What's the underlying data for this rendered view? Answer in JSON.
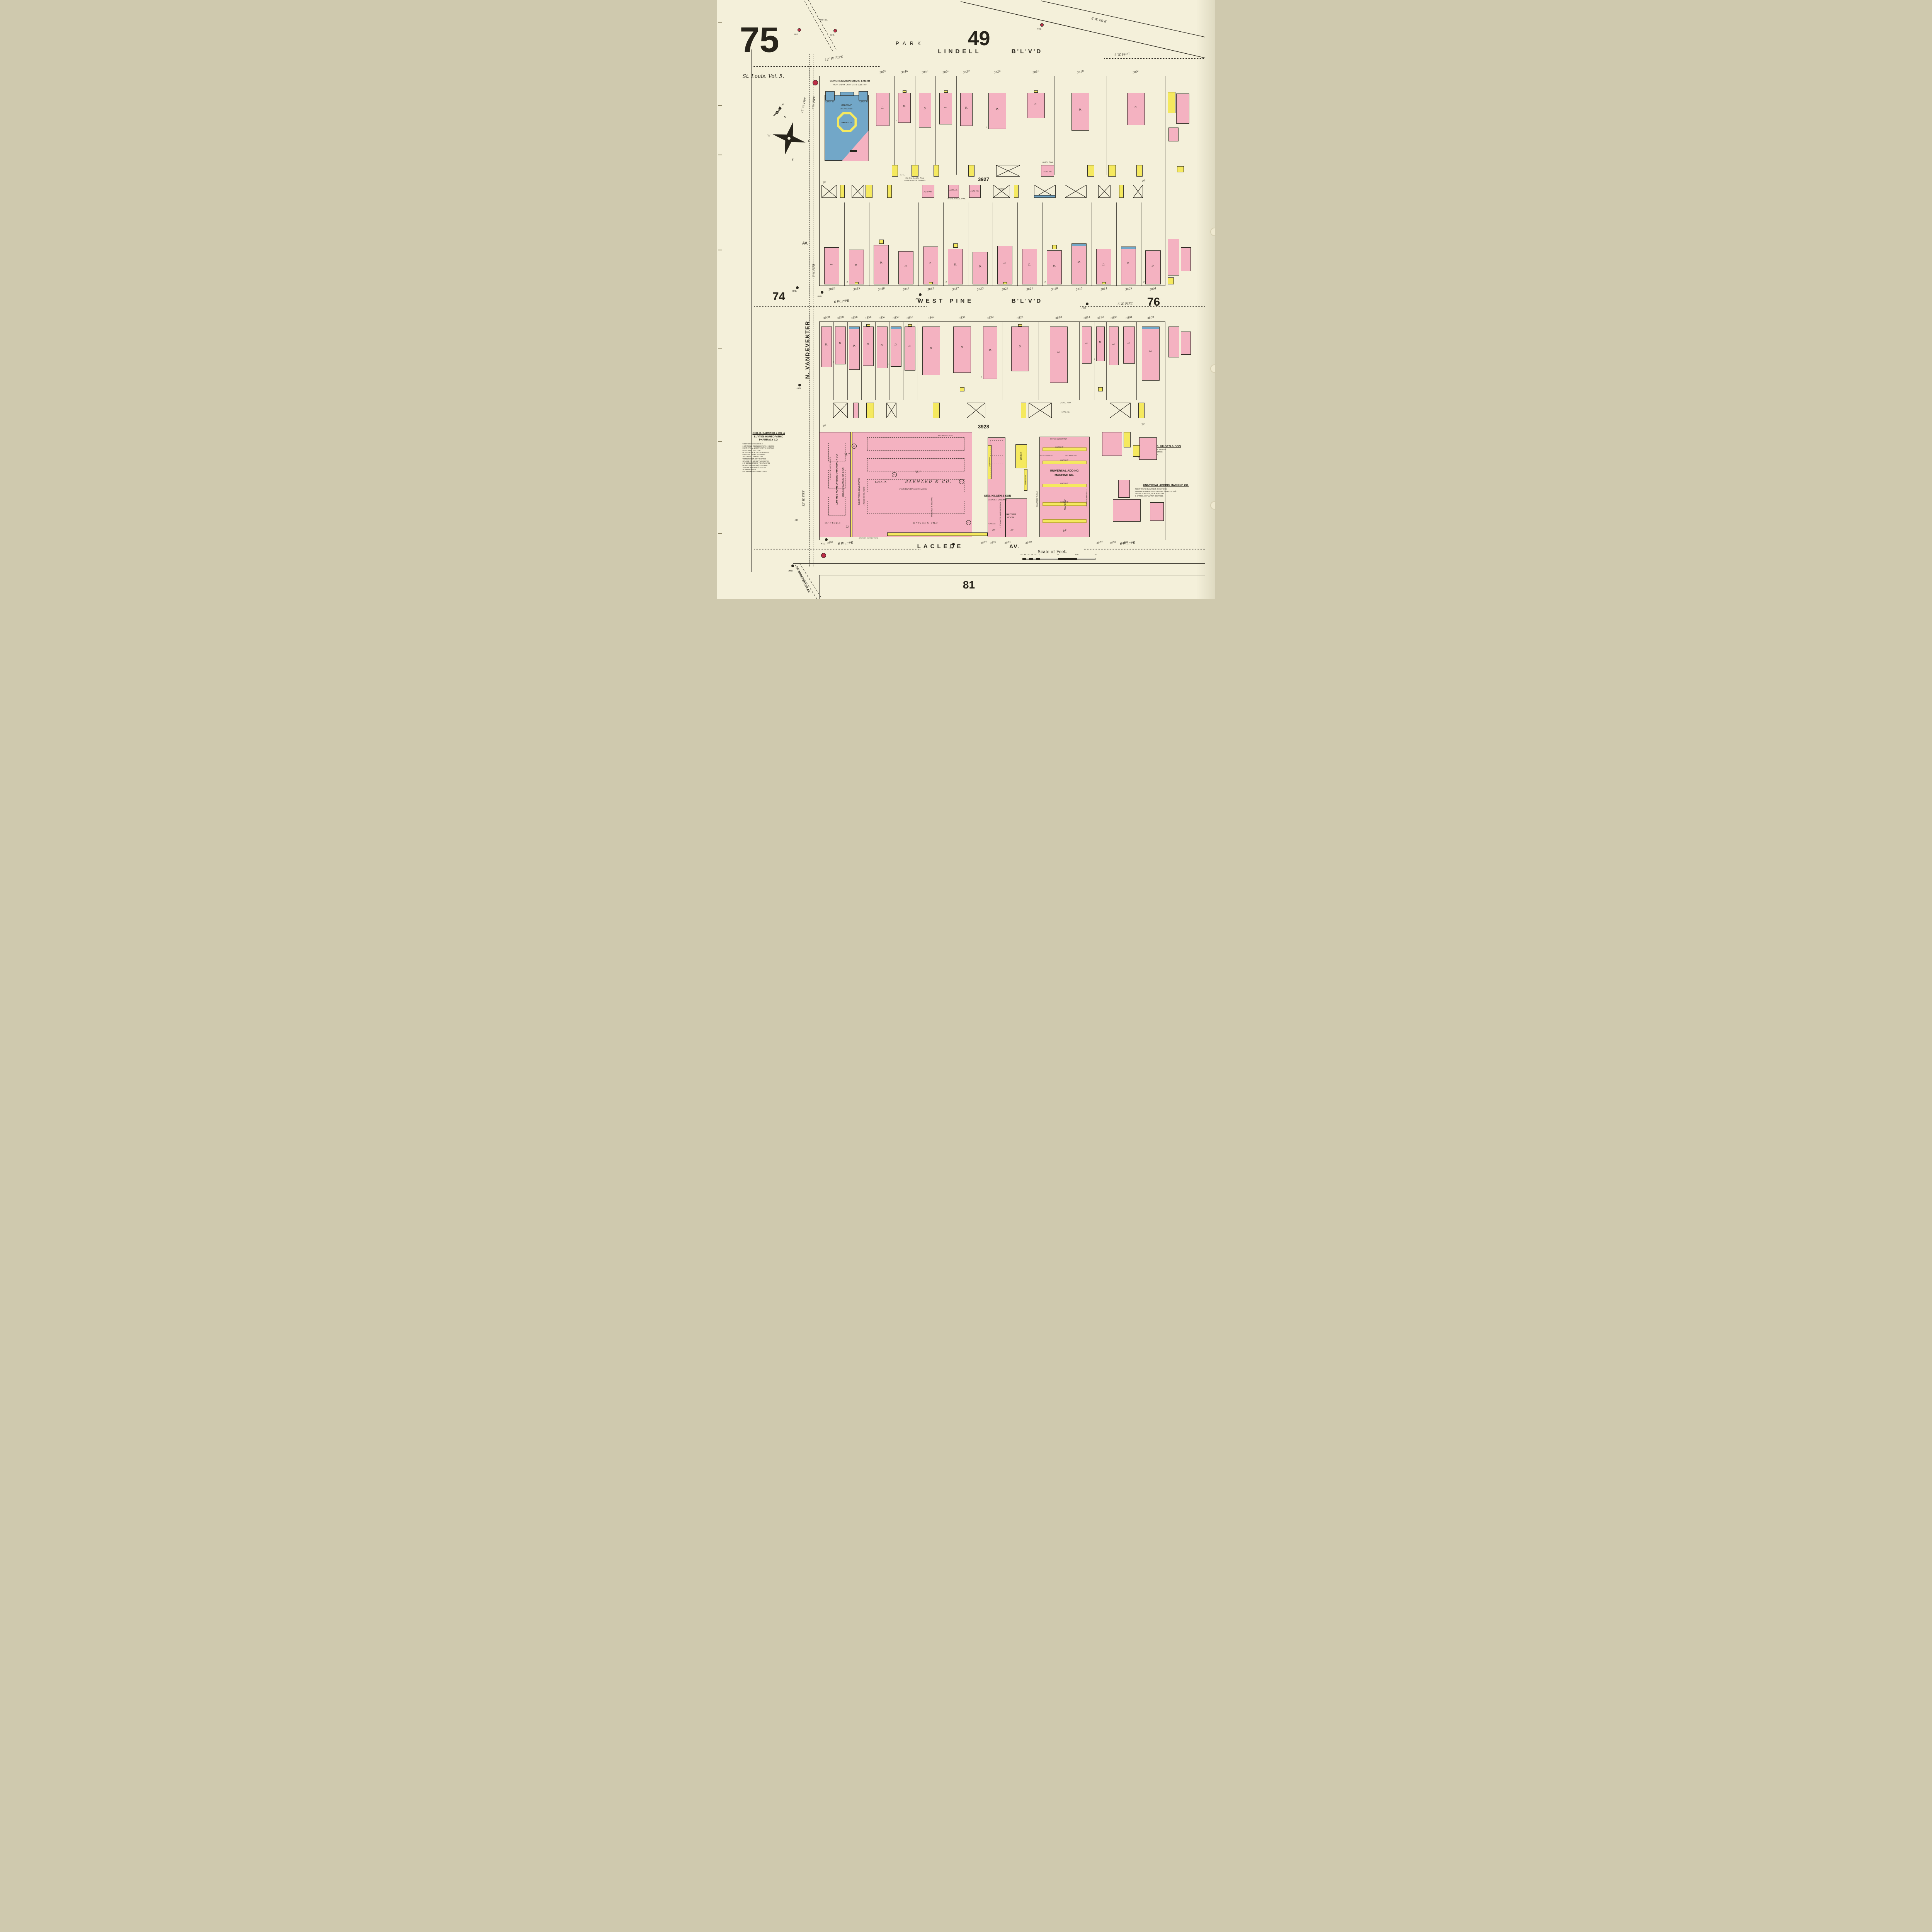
{
  "page": {
    "sheet_number": "75",
    "volume": "St. Louis. Vol. 5.",
    "adjacent_top": "49",
    "adjacent_left": "74",
    "adjacent_right": "76",
    "adjacent_bottom": "81"
  },
  "streets": {
    "park": "PARK",
    "lindell_1": "LINDELL",
    "lindell_2": "B'L'V'D",
    "west_pine_1": "WEST PINE",
    "west_pine_2": "B'L'V'D",
    "laclede_1": "LACLEDE",
    "laclede_2": "AV.",
    "vandeventer": "N. VANDEVENTER",
    "vandeventer_av": "AV.",
    "s_vandeventer": "S.VANDEVENTER AV."
  },
  "pipes": {
    "p12": "12″ W. PIPE",
    "p6": "6 W. PIPE"
  },
  "symbols": {
    "dwelling": "D.",
    "hydrant": "HYD.",
    "patrol": "PATROL",
    "auto_house": "AUTO HO.",
    "out_house": "OUT HO.",
    "sprinkler": "A.S",
    "sleeping_closet": "SL. CL.",
    "stories2": "2"
  },
  "blocks": {
    "b3927": {
      "number": "3927",
      "lindell_lots": [
        "3852",
        "3846",
        "3840",
        "3836",
        "3832",
        "3824",
        "3818",
        "3810",
        "3800"
      ],
      "west_pine_lots": [
        "3863",
        "3855",
        "3849",
        "3847",
        "3843",
        "3837",
        "3833",
        "3829",
        "3821",
        "3819",
        "3815",
        "3811",
        "3805",
        "3801"
      ],
      "synagogue": {
        "name": "CONGREGATION SHARE EMETH",
        "utilities": "HEAT: STEAM, LIGHT: GAS & ELECTRIC",
        "tower_left": "TOWER 80'",
        "tower_right": "TOWER 45'",
        "balcony": "BALCONY",
        "eaves": "30' TO EAVES",
        "raised": "RAISED 15'"
      },
      "tank_note_1a": "550 GAL. GASOL. TANK",
      "tank_note_1b": "BURIED UNDER GROUND",
      "tank_note_2": "60 GAL. GASOL. TANK",
      "tank_note_3": "GASOL. TANK",
      "alley_width": "20'"
    },
    "b3928": {
      "number": "3928",
      "west_pine_lots": [
        "3860",
        "3858",
        "3856",
        "3854",
        "3852",
        "3850",
        "3848",
        "3842",
        "3836",
        "3832",
        "3828",
        "3818",
        "3814",
        "3812",
        "3808",
        "3804",
        "3800"
      ],
      "laclede_lots": [
        "3863",
        "3827",
        "3825",
        "3821",
        "3819",
        "3807",
        "3803",
        "3801"
      ],
      "tank_note": "GASOL. TANK",
      "alley_width": "20'",
      "frontage_60": "60'"
    }
  },
  "factory": {
    "rows2": "2 ROWS OF WOOD POSTS",
    "luyties_vertical": "LUYTIES HOMEOPATHIC PHARMACY CO.",
    "medicine": "MEDICINE FACTORY 1ST & 2ND",
    "bldg_a": "\"A.\"",
    "bldg_b": "\"B.\"",
    "sales": "SALES ROOM & ENGRAVING",
    "rows4": "4 ROWS WOOD POSTS",
    "printing": "PRINTING & BINDING",
    "geo_d": "GEO. D.",
    "barnard": "BARNARD & CO.",
    "see_margin": "FOR REPORT SEE MARGIN",
    "wood_posts_1st": "WOOD POSTS 1ST",
    "offices": "OFFICES",
    "offices_2nd": "OFFICES 2ND",
    "kilgen": "GEO. KILGEN & SON",
    "organs": "CHURCH ORGANS",
    "bench": "1 ROW WOOD WORKING BENCH.",
    "office": "OFFICE",
    "erecting_1": "ERECTING",
    "erecting_2": "ROOM",
    "lumber": "LUMBER",
    "lumber_shed": "LUMBER SHED",
    "concrete": "CONCRETE FLOOR",
    "universal_1": "UNIVERSAL ADDING",
    "universal_2": "MACHINE CO.",
    "machine_vert": "MACHINE",
    "raised5": "RAISED 5'",
    "generator": "400 AMP. GENERATOR",
    "tile_wall": "TILE WALL 2ND",
    "rows7": "7 ROWS WOOD POSTS",
    "steamer": "STEAMER CONNECTIONS",
    "d16": "16'",
    "d22": "22'",
    "d26": "26'"
  },
  "reports": {
    "barnard": {
      "title": [
        "GEO. D. BARNARD & CO. &",
        "LUYTIES HOMEOPATHIC",
        "PHARMACY CO."
      ],
      "body": [
        "NIGHT WATCHMAN M.D.T.",
        "6 STATIONS, ROUNDS EVERY 2 HOURS.",
        "HEAT: STEAM & HOT AIR (FAN SYSTEM)",
        "LIGHT: ELECTRIC I.E.P.",
        "65 H.P. 45 H.P. & 130 H.P. ENGINS.",
        "NIAGARA, ESTEY & GRINNELL",
        "AUTOMATIC SPRINKLERS",
        "THROUGHOUT. DRY SYSTEM.",
        "SPACED 8' X 10' SUPPLIED WITH",
        "2-4\" CONNECTIONS TO CITY MAIN.",
        "(50 LBS. PRESSURE) & 1 GRAVITY",
        "TANK OF 1300 GALS. PLACED",
        "25' ABOVE ROOF.",
        "5-3\" STEAMER CONNECTIONS."
      ]
    },
    "kilgen": {
      "title": "GEO. KILGEN & SON",
      "body": [
        "NO WATCHMAN. HEAT: STOVES.",
        "LIGHT & POWER ELECTRIC.",
        "BUCKETS & BARRELS,",
        "OF WATER DISTRIBD."
      ]
    },
    "universal": {
      "title": "UNIVERSAL ADDING MACHINE CO.",
      "body": [
        "NIGHT WATCHMAN M.D.T. 7 STATIONS",
        "HOURLY ROUNDS. HEAT: HOT AIR (FAN SYSTEM).",
        "LIGHTS ELECTRIC, I.E.P.  BUCKETS",
        "& BARRELS OF WATER DISTRIBD."
      ]
    }
  },
  "scale": {
    "title": "Scale of Feet.",
    "ticks": [
      "50",
      "40",
      "30",
      "20",
      "10",
      "0",
      "50",
      "100",
      "150"
    ]
  },
  "compass": {
    "north": "N",
    "east": "E",
    "south": "S",
    "west": "W"
  },
  "colors": {
    "paper": "#f4f0da",
    "dwelling_pink": "#f4b2c1",
    "frame_yellow": "#f5e95f",
    "special_blue": "#72a7c8",
    "alarm_red": "#bb2e47",
    "ink": "#27241b"
  }
}
